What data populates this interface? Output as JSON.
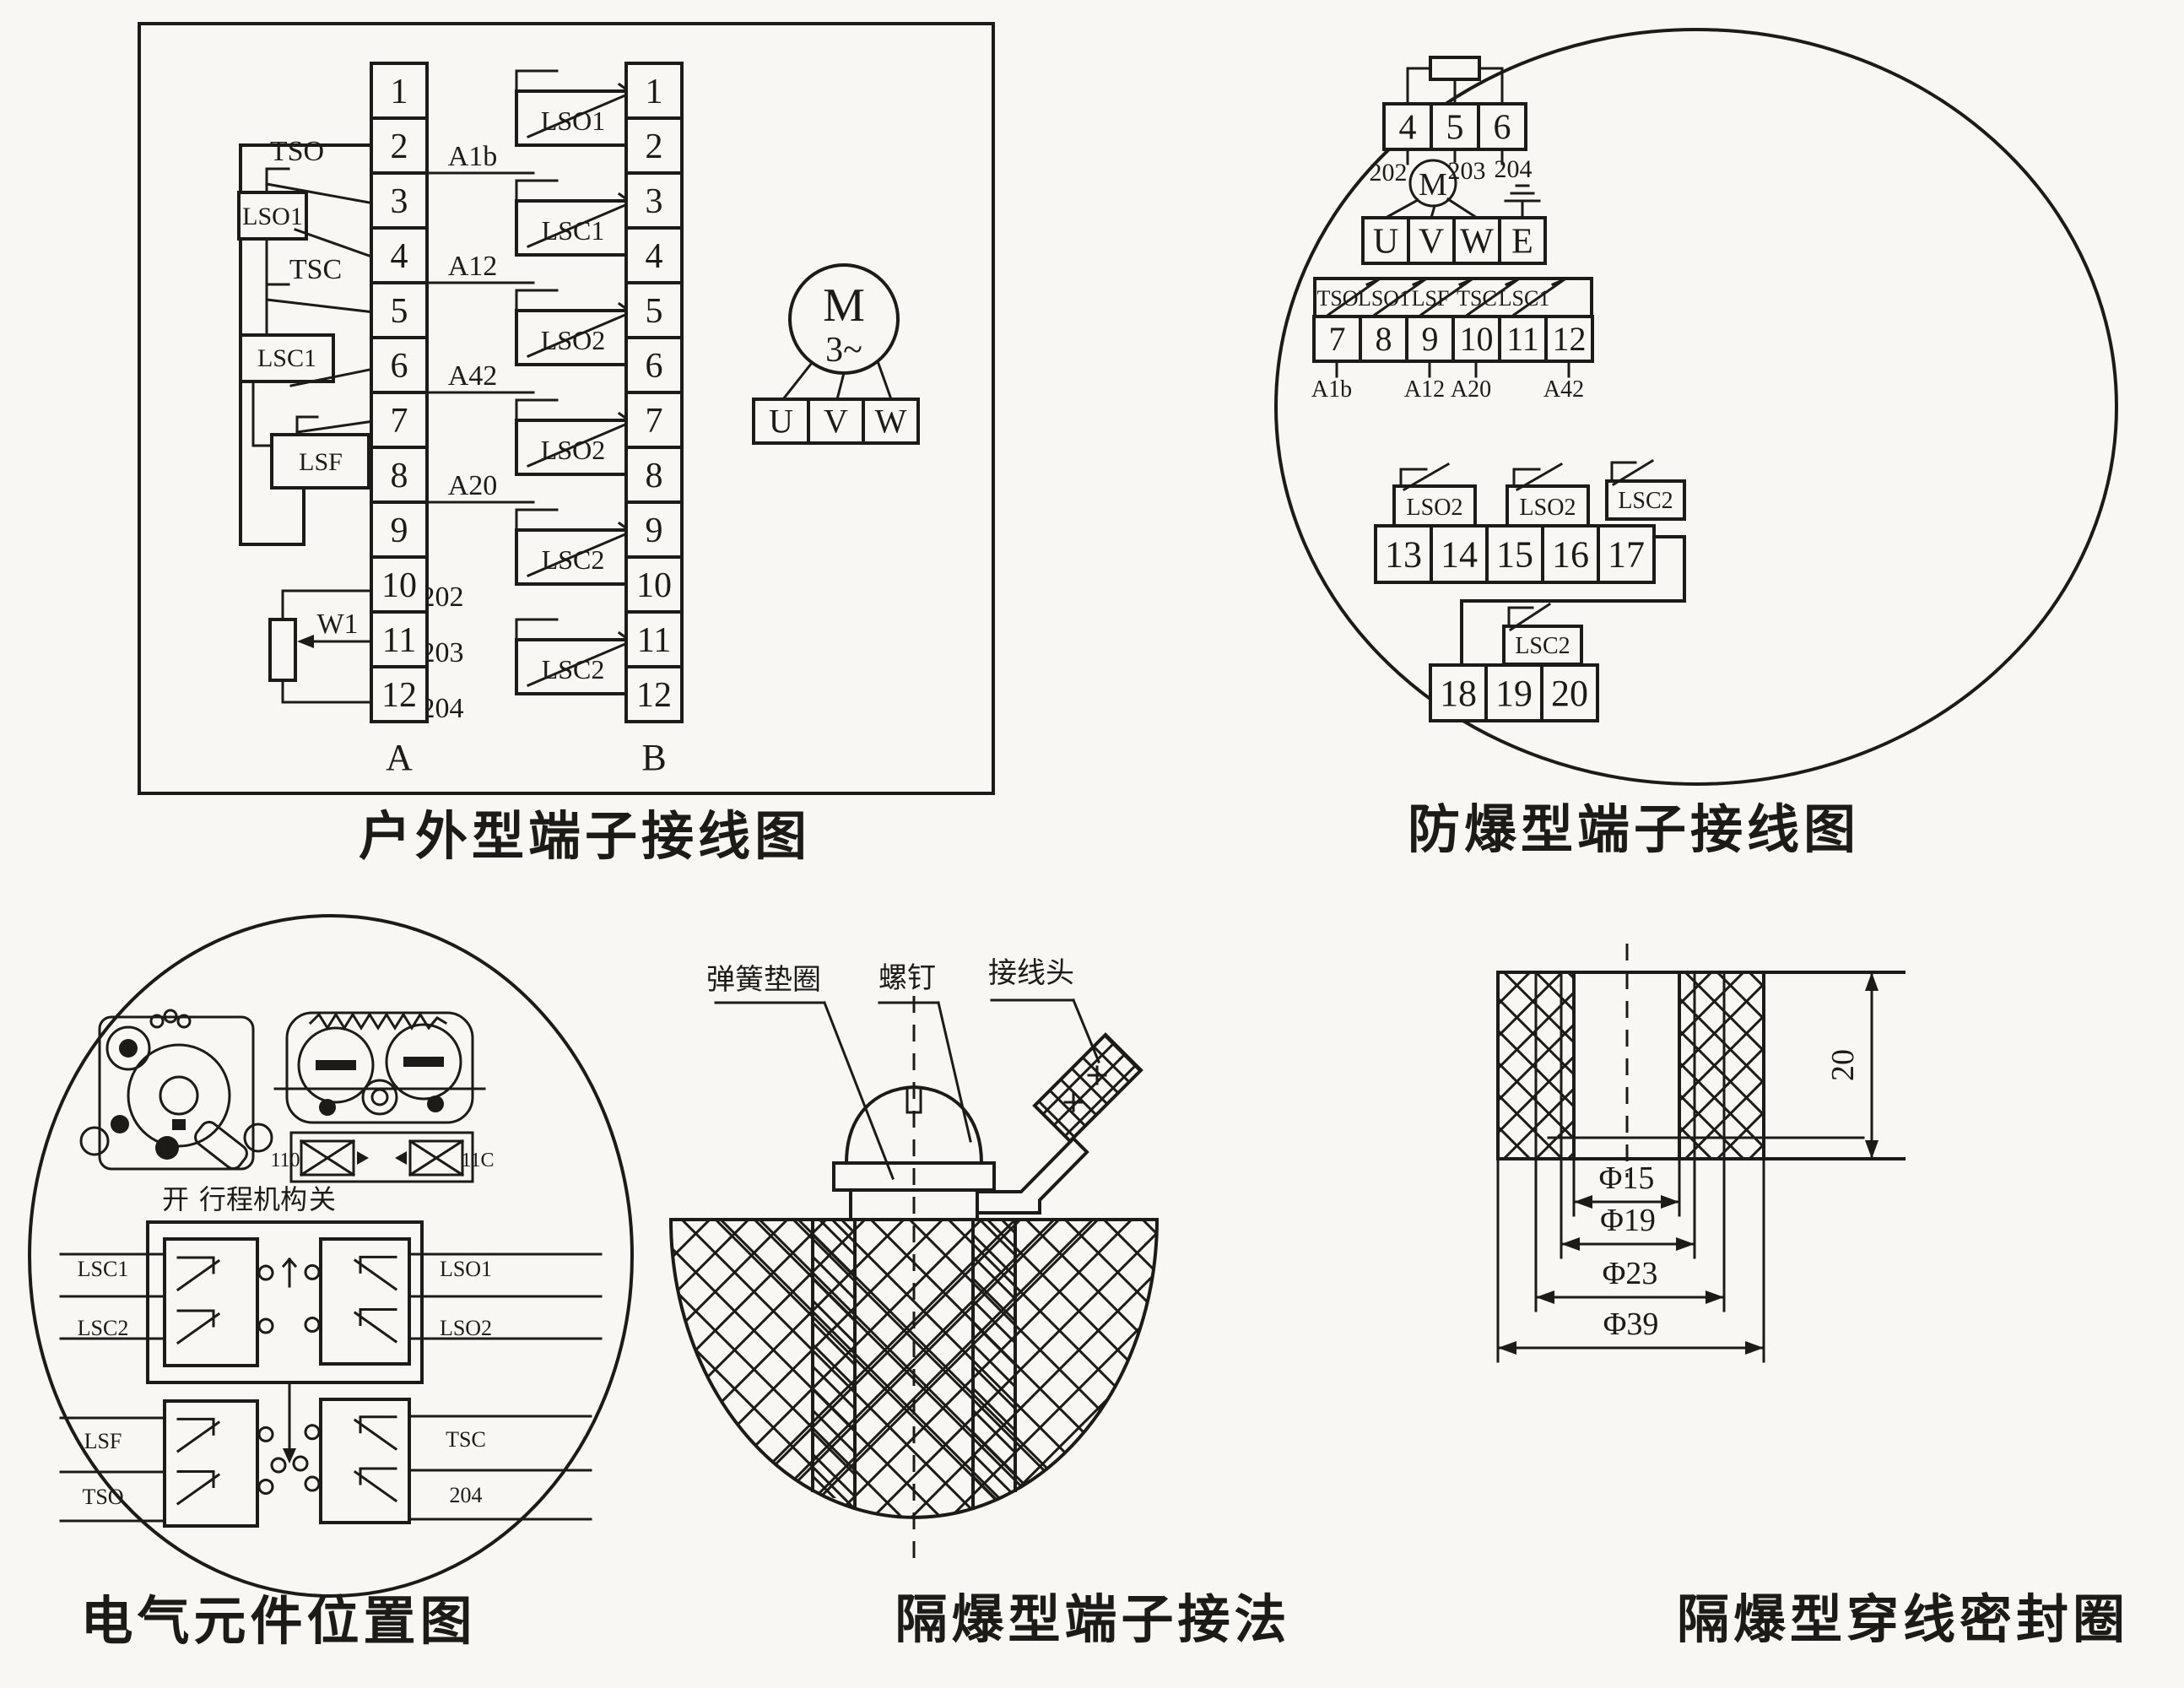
{
  "colors": {
    "ink": "#1d1b18",
    "paper": "#f8f7f4"
  },
  "outdoor": {
    "caption": "户外型端子接线图",
    "terminals_a": [
      "1",
      "2",
      "3",
      "4",
      "5",
      "6",
      "7",
      "8",
      "9",
      "10",
      "11",
      "12"
    ],
    "terminals_b": [
      "1",
      "2",
      "3",
      "4",
      "5",
      "6",
      "7",
      "8",
      "9",
      "10",
      "11",
      "12"
    ],
    "col_a_label": "A",
    "col_b_label": "B",
    "switch_tso": "TSO",
    "switch_lso1": "LSO1",
    "switch_tsc": "TSC",
    "switch_lsc1": "LSC1",
    "switch_lsf": "LSF",
    "wire_a1b": "A1b",
    "wire_a12": "A12",
    "wire_a42": "A42",
    "wire_a20": "A20",
    "pot_label": "W1",
    "wire_202": "202",
    "wire_203": "203",
    "wire_204": "204",
    "b_switches": [
      "LSO1",
      "LSC1",
      "LSO2",
      "LSO2",
      "LSC2",
      "LSC2"
    ],
    "motor_letter": "M",
    "motor_phase": "3~",
    "motor_terms": [
      "U",
      "V",
      "W"
    ]
  },
  "explosion": {
    "caption": "防爆型端子接线图",
    "row1": [
      "4",
      "5",
      "6"
    ],
    "row1_wires": [
      "202",
      "203",
      "204"
    ],
    "motor_letter": "M",
    "phase_row": [
      "U",
      "V",
      "W",
      "E"
    ],
    "row2_switches": [
      "TSO",
      "LSO1",
      "LSF",
      "TSC",
      "LSC1"
    ],
    "row2": [
      "7",
      "8",
      "9",
      "10",
      "11",
      "12"
    ],
    "row2_wires": [
      "A1b",
      "A12",
      "A20",
      "A42"
    ],
    "row3_switches": [
      "LSO2",
      "LSO2",
      "LSC2"
    ],
    "row3": [
      "13",
      "14",
      "15",
      "16",
      "17"
    ],
    "row4_switch": "LSC2",
    "row4": [
      "18",
      "19",
      "20"
    ]
  },
  "position": {
    "caption": "电气元件位置图",
    "open_label": "开",
    "mechanism_label": "行程机构",
    "close_label": "关",
    "upper_left_leads": [
      "LSC1",
      "LSC2"
    ],
    "upper_right_leads": [
      "LSO1",
      "LSO2"
    ],
    "lower_left_leads": [
      "LSF",
      "TSO"
    ],
    "lower_right_leads": [
      "TSC",
      "204"
    ],
    "terminal_marks": [
      "110",
      "11C"
    ]
  },
  "connection": {
    "caption": "隔爆型端子接法",
    "callout_washer": "弹簧垫圈",
    "callout_screw": "螺钉",
    "callout_lug": "接线头"
  },
  "seal": {
    "caption": "隔爆型穿线密封圈",
    "height_dim": "20",
    "diameters": [
      "Φ15",
      "Φ19",
      "Φ23",
      "Φ39"
    ]
  }
}
